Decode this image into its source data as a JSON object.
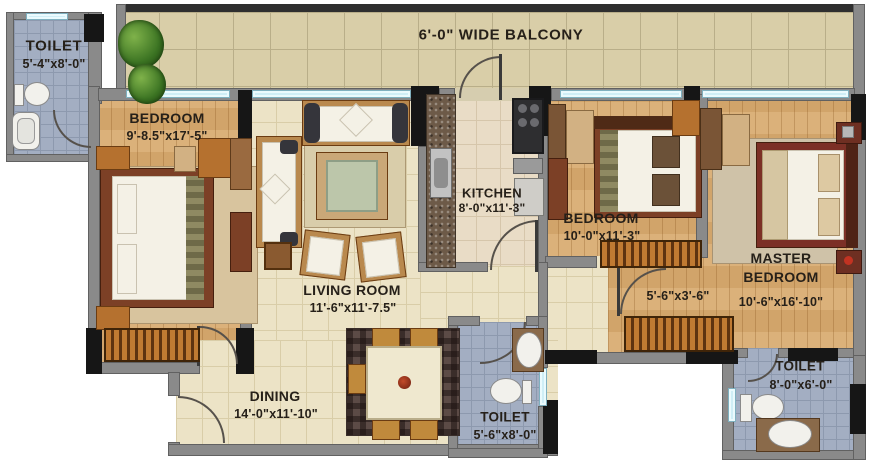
{
  "labels": {
    "balcony": "6'-0\" WIDE BALCONY",
    "toilet_top_left": {
      "name": "TOILET",
      "dims": "5'-4\"x8'-0\""
    },
    "bedroom_left": {
      "name": "BEDROOM",
      "dims": "9'-8.5\"x17'-5\""
    },
    "living_room": {
      "name": "LIVING ROOM",
      "dims": "11'-6\"x11'-7.5\""
    },
    "kitchen": {
      "name": "KITCHEN",
      "dims": "8'-0\"x11'-3\""
    },
    "bedroom_middle": {
      "name": "BEDROOM",
      "dims": "10'-0\"x11'-3\""
    },
    "passage": {
      "dims": "5'-6\"x3'-6\""
    },
    "master_bedroom": {
      "name_line1": "MASTER",
      "name_line2": "BEDROOM",
      "dims": "10'-6\"x16'-10\""
    },
    "dining": {
      "name": "DINING",
      "dims": "14'-0\"x11'-10\""
    },
    "toilet_bottom_center": {
      "name": "TOILET",
      "dims": "5'-6\"x8'-0\""
    },
    "toilet_bottom_right": {
      "name": "TOILET",
      "dims": "8'-0\"x6'-0\""
    }
  },
  "colors": {
    "wall": "#8a8a8a",
    "wall_black": "#161616",
    "window_glass": "#cfeef6",
    "wood_floor": "#d8ab70",
    "tile_floor": "#ece3c6",
    "balcony_floor": "#d9cea8",
    "toilet_floor": "#a3aec2",
    "furniture_wood": "#b5712f",
    "bed_frame": "#7c4026",
    "upholstery": "#f4f1e6",
    "label_text": "#262019"
  }
}
